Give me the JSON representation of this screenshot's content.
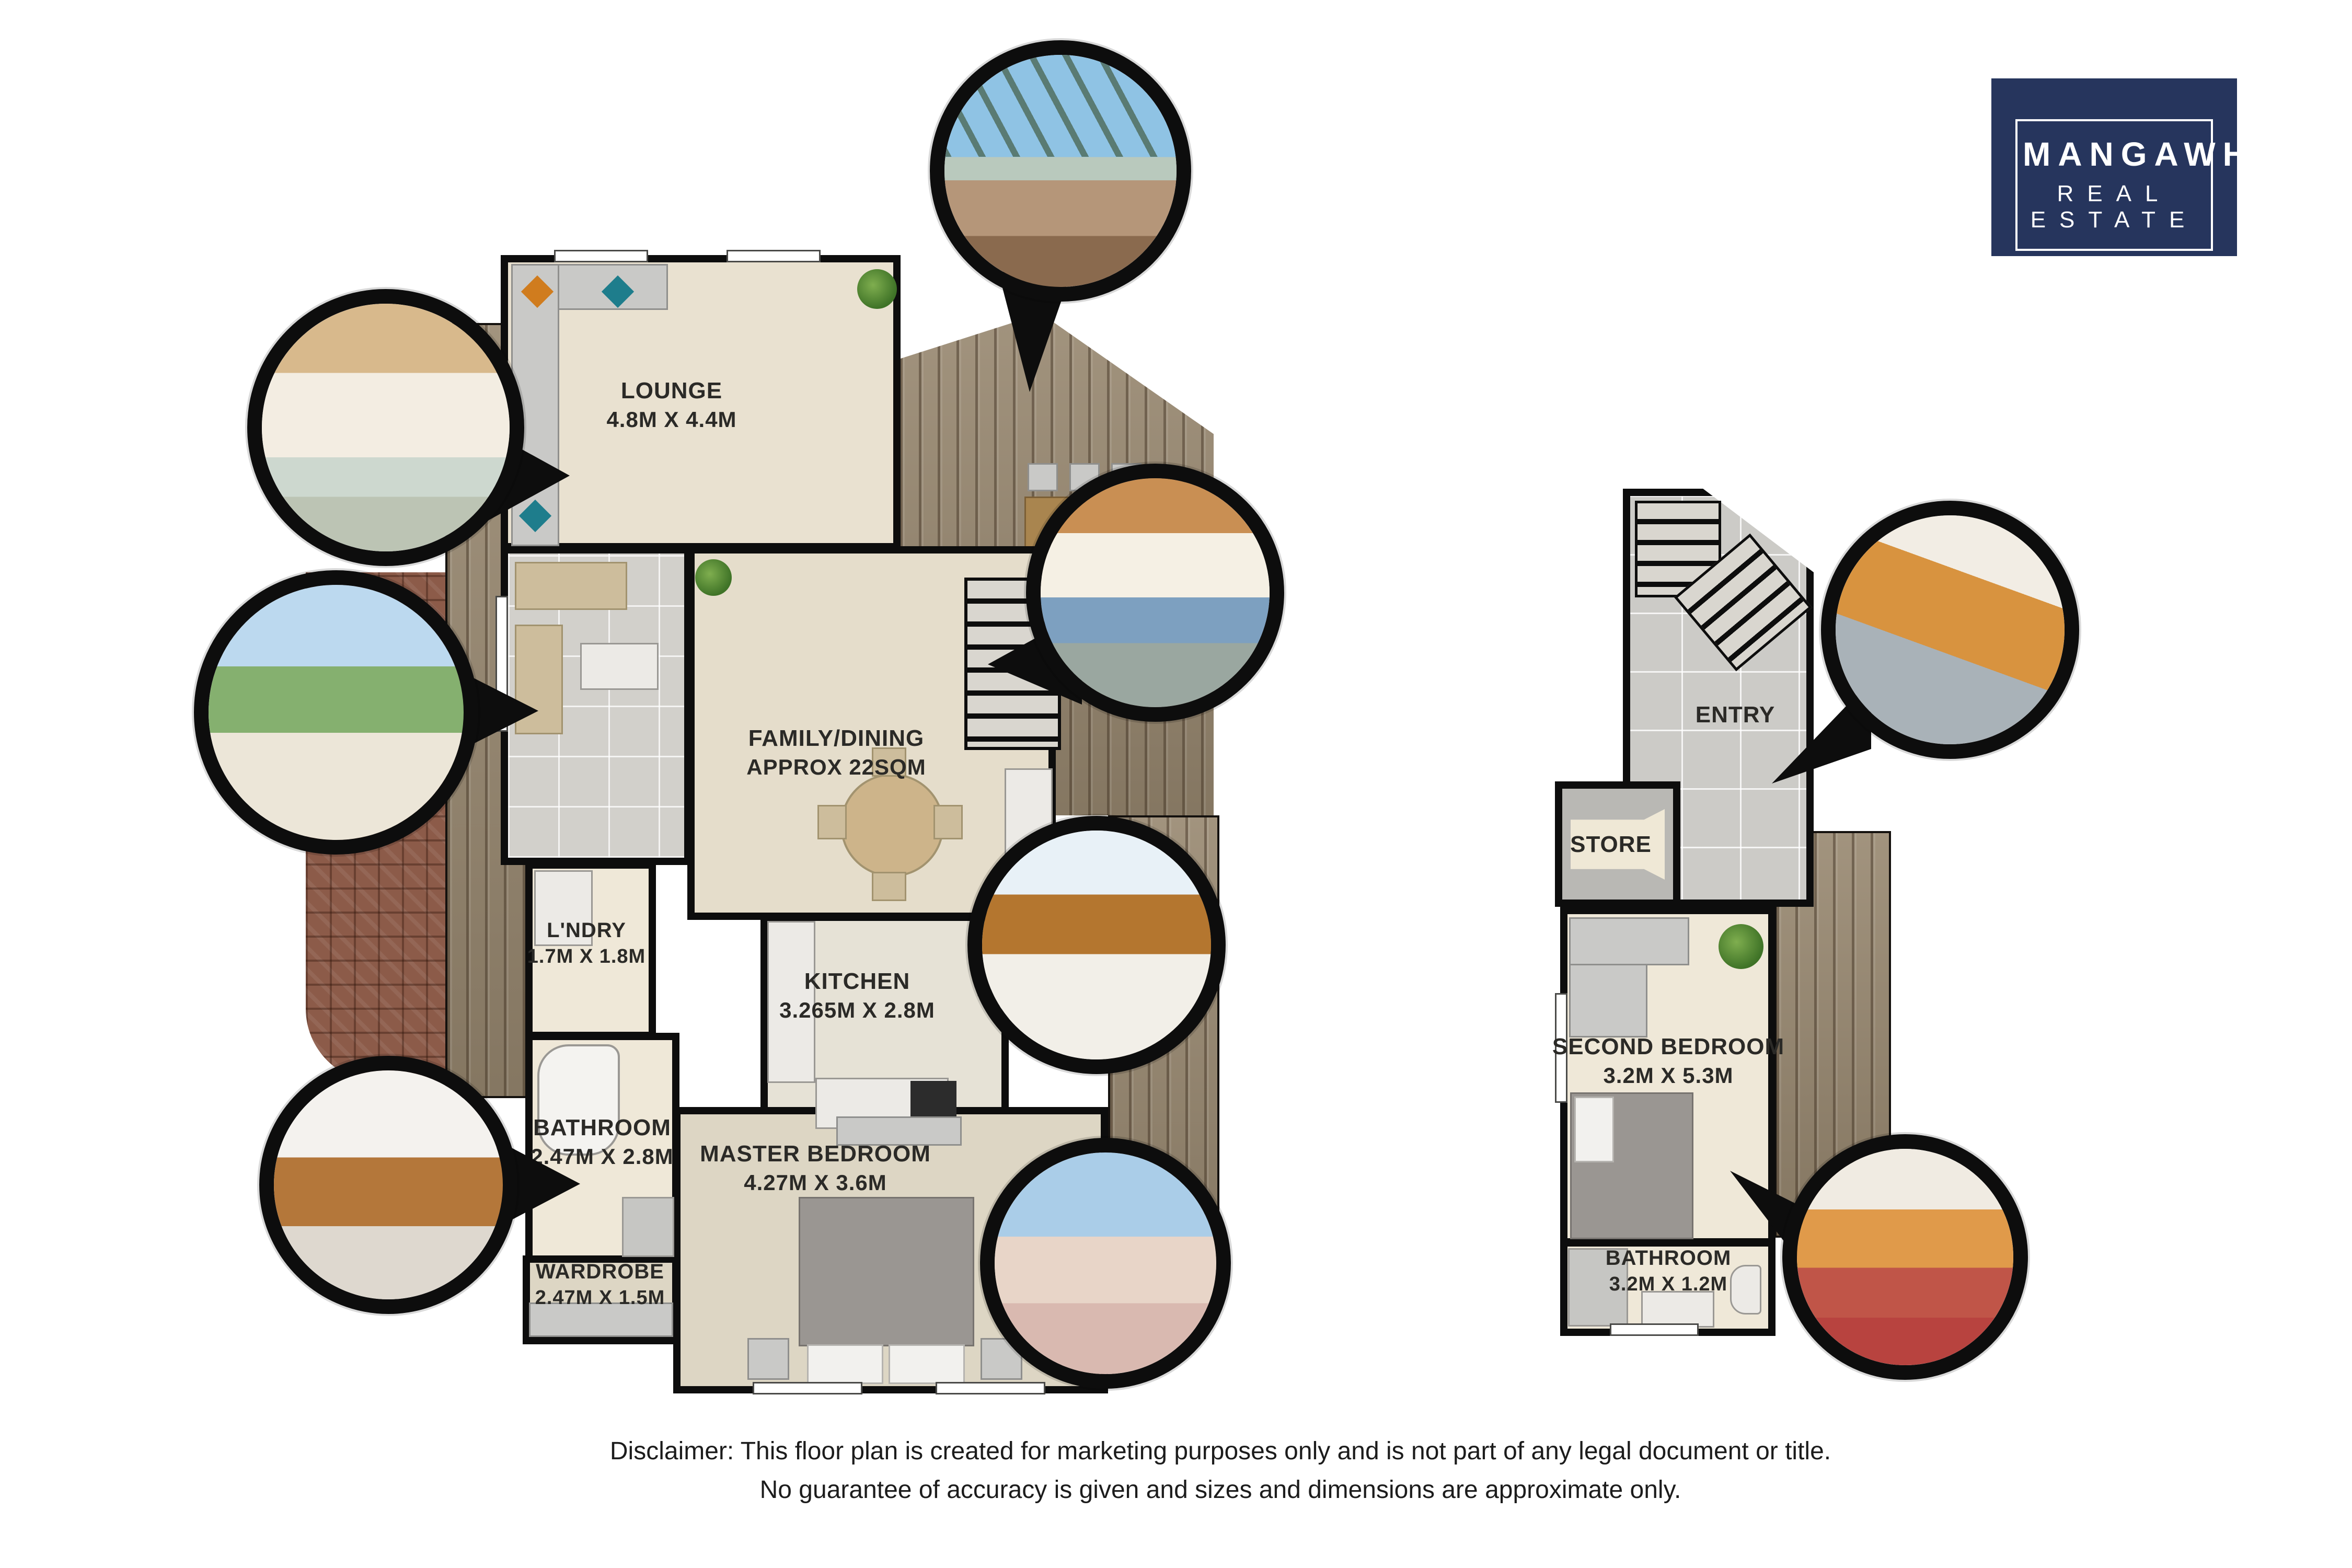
{
  "logo": {
    "brand_line1": "MANGAWHAI",
    "brand_line2": "REAL ESTATE",
    "tagline": "A BRANCH OF INDEPENDENT AGENT LIMITED",
    "license": "LICENSED REAA (2008)"
  },
  "floor_main": {
    "lounge": {
      "name": "LOUNGE",
      "dims": "4.8M X 4.4M"
    },
    "family_dining": {
      "name": "FAMILY/DINING",
      "dims": "APPROX 22SQM"
    },
    "laundry": {
      "name": "L'NDRY",
      "dims": "1.7M X 1.8M"
    },
    "kitchen": {
      "name": "KITCHEN",
      "dims": "3.265M X 2.8M"
    },
    "bathroom": {
      "name": "BATHROOM",
      "dims": "2.47M X 2.8M"
    },
    "master_bedroom": {
      "name": "MASTER BEDROOM",
      "dims": "4.27M X 3.6M"
    },
    "wardrobe": {
      "name": "WARDROBE",
      "dims": "2.47M X 1.5M"
    }
  },
  "floor_lower": {
    "entry": {
      "name": "ENTRY"
    },
    "store": {
      "name": "STORE"
    },
    "second_bedroom": {
      "name": "SECOND BEDROOM",
      "dims": "3.2M X 5.3M"
    },
    "bathroom": {
      "name": "BATHROOM",
      "dims": "3.2M X 1.2M"
    }
  },
  "disclaimer": {
    "line1": "Disclaimer: This floor plan is created for marketing purposes only and is not part of any legal document or title.",
    "line2": "No guarantee of accuracy is given and sizes and dimensions are approximate only."
  },
  "photos": {
    "deck_pergola": "outdoor-deck-pergola",
    "sunroom_interior": "sunroom-interior",
    "conservatory": "conservatory-garden-seating",
    "living_room": "living-dining-timber-ceiling",
    "kitchen": "kitchen-timber-cabinets",
    "master_bedroom": "master-bedroom-balcony-view",
    "bathroom_vanity": "bathroom-vanity-shower",
    "entry_stairs": "entry-staircase",
    "second_bedroom": "second-bedroom-orange-walls"
  },
  "colors": {
    "logo_navy": "#26355d",
    "wall": "#0d0d0d",
    "floor_cream": "#e9e1d0",
    "deck_wood": "#97876f",
    "brick_patio": "#8c5b49",
    "tile_gray": "#cccbc7"
  }
}
